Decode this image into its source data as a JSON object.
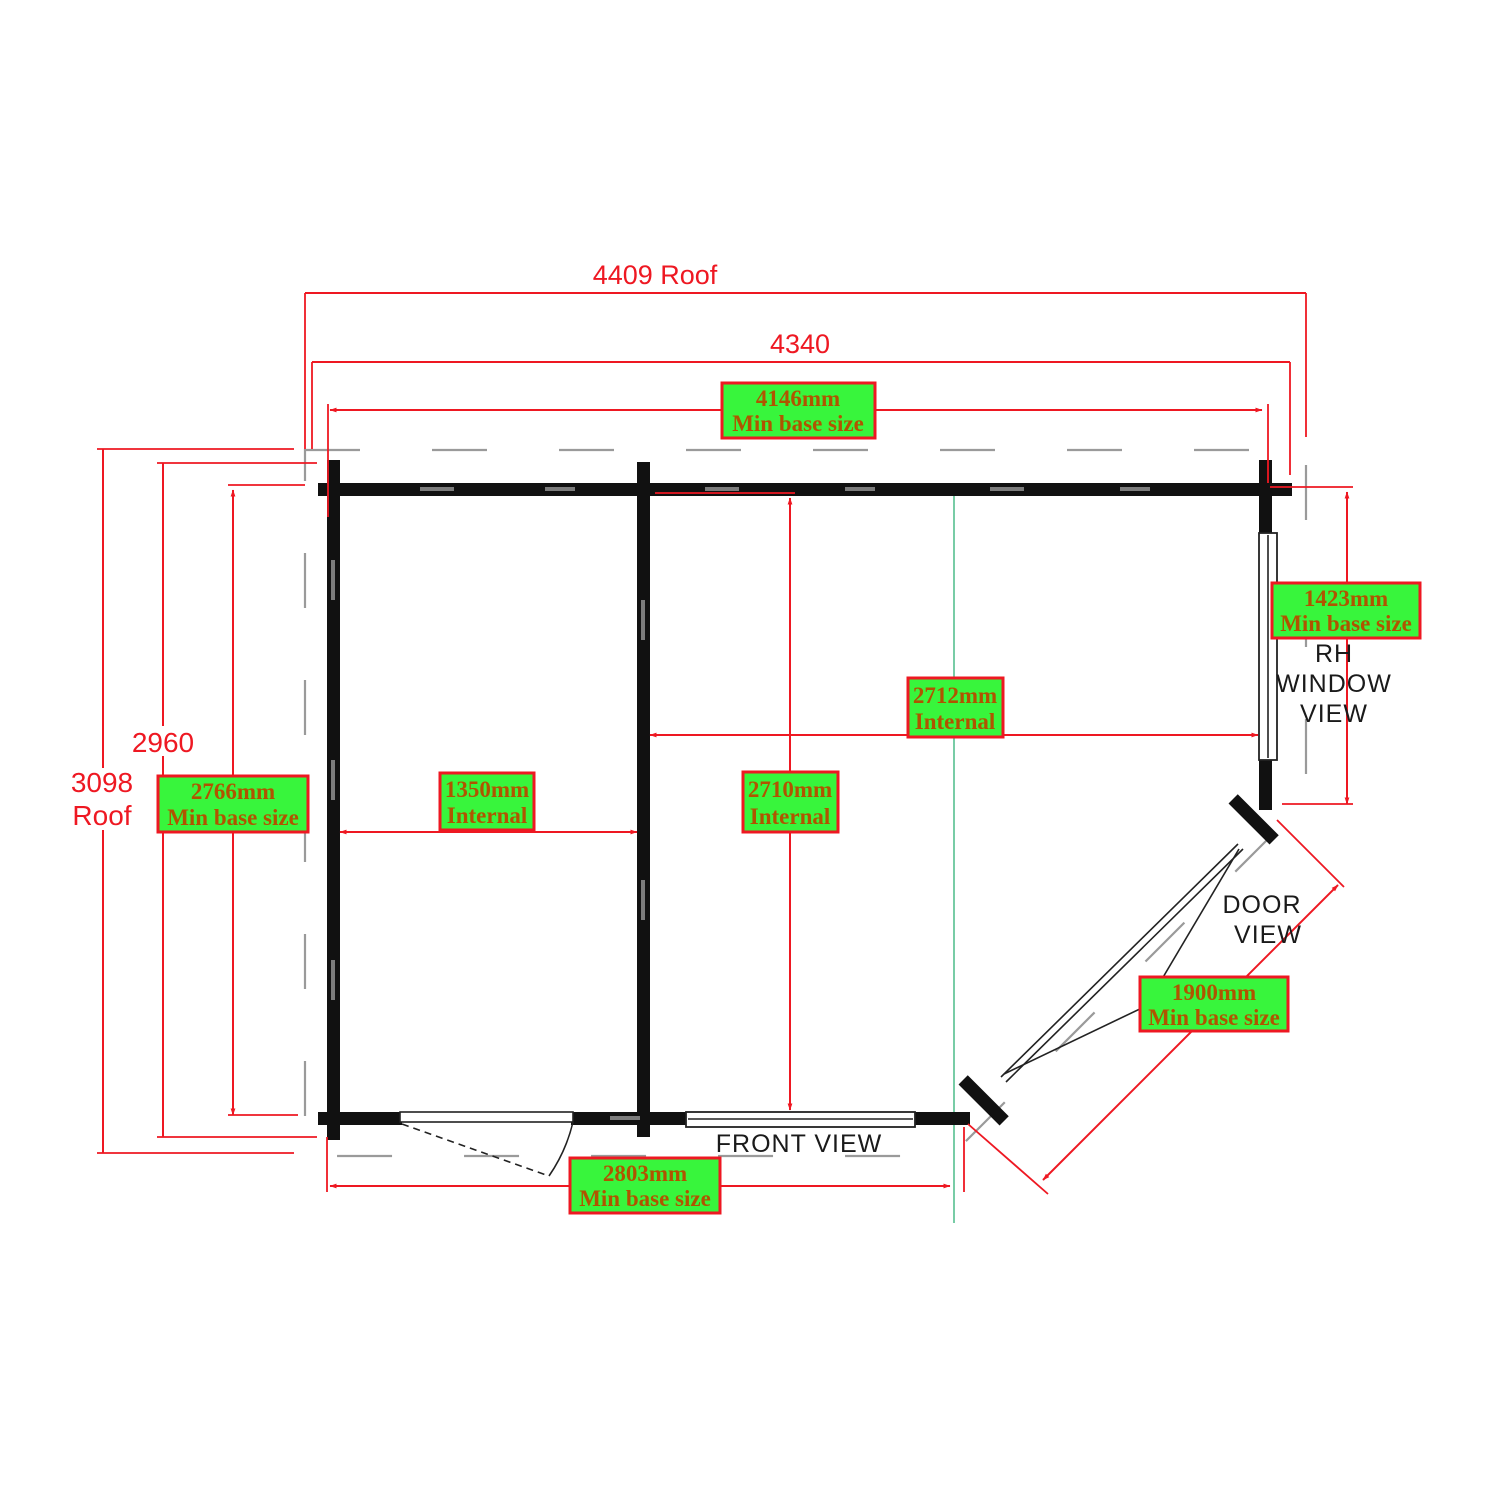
{
  "colors": {
    "dimension_red": "#ee1822",
    "wall_black": "#111111",
    "green_box_fill": "#38f53c",
    "green_box_border": "#ee1822",
    "green_box_text": "#b05400",
    "guide_teal": "#56c090",
    "roof_outline_gray": "#9a9a9a",
    "label_black": "#1a1a1a"
  },
  "plan": {
    "dim_roof_width": "4409 Roof",
    "dim_overall_width": "4340",
    "dim_depth": "2960",
    "dim_roof_depth_line1": "3098",
    "dim_roof_depth_line2": "Roof",
    "boxes": {
      "base_width": {
        "line1": "4146mm",
        "line2": "Min base size"
      },
      "base_depth": {
        "line1": "2766mm",
        "line2": "Min base size"
      },
      "internal_left": {
        "line1": "1350mm",
        "line2": "Internal"
      },
      "internal_depth": {
        "line1": "2710mm",
        "line2": "Internal"
      },
      "internal_width": {
        "line1": "2712mm",
        "line2": "Internal"
      },
      "base_window_side": {
        "line1": "1423mm",
        "line2": "Min base size"
      },
      "base_door_side": {
        "line1": "1900mm",
        "line2": "Min base size"
      },
      "base_front": {
        "line1": "2803mm",
        "line2": "Min base size"
      }
    },
    "views": {
      "front": "FRONT VIEW",
      "door_line1": "DOOR",
      "door_line2": "VIEW",
      "window_line1": "RH",
      "window_line2": "WINDOW",
      "window_line3": "VIEW"
    }
  }
}
